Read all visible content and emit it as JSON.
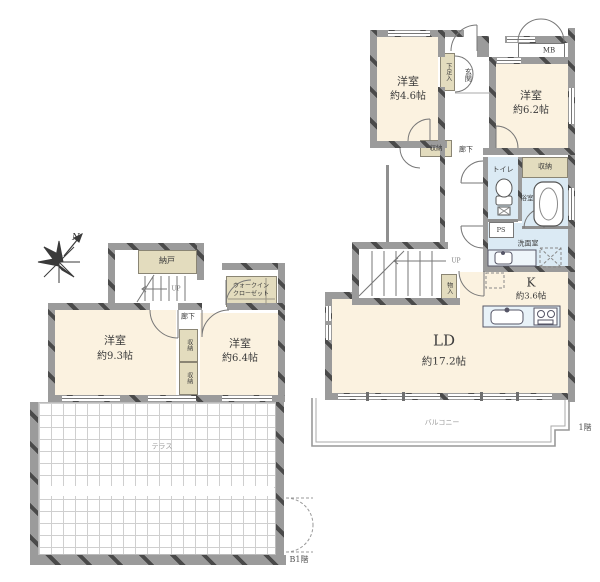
{
  "meta": {
    "compass_n": "N"
  },
  "colors": {
    "room": "#fbf2e0",
    "closet": "#e3dcbe",
    "wet": "#dbeaf4",
    "wall": "#9b9b9b",
    "grid": "#cfcfcf"
  },
  "b1": {
    "floor_label": "B1階",
    "bedroom93": {
      "name": "洋室",
      "size": "約9.3帖"
    },
    "bedroom64": {
      "name": "洋室",
      "size": "約6.4帖"
    },
    "nando": "納戸",
    "wic_line1": "ウォークイン",
    "wic_line2": "クローゼット",
    "hallway": "廊下",
    "closet_a": "収納",
    "closet_b": "収納",
    "terrace": "テラス",
    "up": "UP"
  },
  "f1": {
    "floor_label": "1階",
    "bedroom46": {
      "name": "洋室",
      "size": "約4.6帖"
    },
    "bedroom62": {
      "name": "洋室",
      "size": "約6.2帖"
    },
    "entrance": "玄関",
    "shoe_box": "下足入",
    "mb": "MB",
    "hall_closet": "収納",
    "hallway": "廊下",
    "toilet": "トイレ",
    "ps": "PS",
    "bath": "浴室",
    "bath_closet": "収納",
    "washroom": "洗面室",
    "kitchen": {
      "name": "K",
      "size": "約3.6帖"
    },
    "living": {
      "name": "LD",
      "size": "約17.2帖"
    },
    "storage_small": "物入",
    "up": "UP",
    "balcony": "バルコニー"
  }
}
